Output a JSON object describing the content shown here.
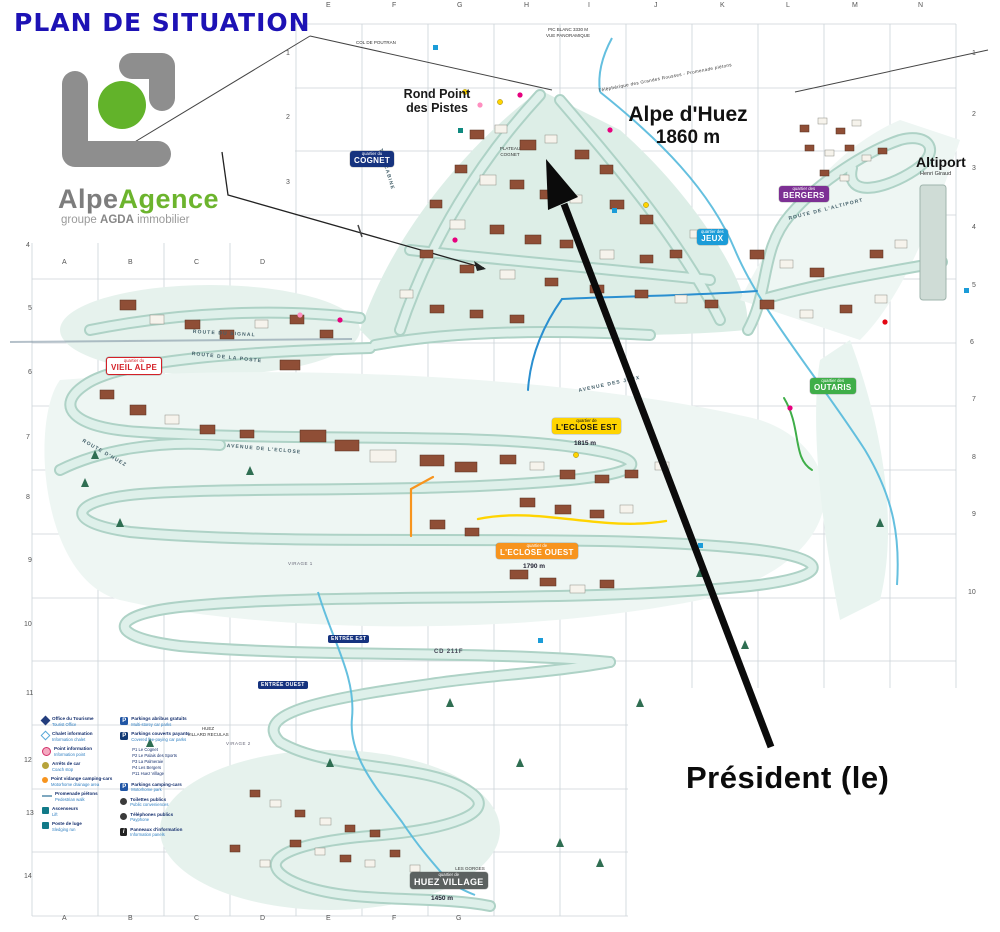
{
  "header": {
    "title": "PLAN DE SITUATION",
    "title_color": "#1d12b5"
  },
  "logo": {
    "brand_gray": "Alpe",
    "brand_green": "Agence",
    "tagline_prefix": "groupe",
    "tagline_bold": "AGDA",
    "tagline_suffix": "immobilier",
    "gray": "#8e8e8e",
    "green": "#62b32a"
  },
  "map": {
    "resort_name": "Alpe d'Huez",
    "resort_altitude": "1860 m",
    "rond_point": "Rond Point\ndes Pistes",
    "altiport": "Altiport",
    "altiport_sub": "Henri Giraud",
    "pic_blanc": "PIC BLANC 3330 M\nVUE PANORAMIQUE",
    "col_poutran": "COL DE POUTRAN",
    "plateau_cognet": "PLATEAU\nCOGNET",
    "telepherique": "Téléphérique des Grandes Rousses - Promenade piétons",
    "cd_road": "CD 211F",
    "gorges": "LES GORGES\nDE SARENNE",
    "villard": "HUEZ\nVILLARD RECULAS",
    "streets": [
      "TÉLÉCABINE",
      "ROUTE DU SIGNAL",
      "ROUTE DE LA POSTE",
      "AVENUE DE L'ECLOSE",
      "ROUTE D'HUEZ",
      "ROUTE DE L'ALTIPORT",
      "AVENUE DES JEUX",
      "VIRAGE 1",
      "VIRAGE 2"
    ]
  },
  "quartiers": {
    "cognet": {
      "prefix": "quartier du",
      "name": "COGNET",
      "color": "#16337f"
    },
    "bergers": {
      "prefix": "quartier des",
      "name": "BERGERS",
      "color": "#7d3094"
    },
    "jeux": {
      "prefix": "quartier des",
      "name": "JEUX",
      "color": "#1b9cd8"
    },
    "vieil_alpe": {
      "prefix": "quartier du",
      "name": "VIEIL ALPE",
      "color": "#d42027"
    },
    "outaris": {
      "prefix": "quartier des",
      "name": "OUTARIS",
      "color": "#3fae49"
    },
    "eclose_est": {
      "prefix": "quartier de",
      "name": "L'ECLOSE EST",
      "altitude": "1815 m",
      "color": "#ffd400"
    },
    "eclose_ouest": {
      "prefix": "quartier de",
      "name": "L'ECLOSE OUEST",
      "altitude": "1790 m",
      "color": "#f7941e"
    },
    "huez_village": {
      "prefix": "quartier de",
      "name": "HUEZ VILLAGE",
      "altitude": "1450 m",
      "color": "#5c6160"
    }
  },
  "entrances": {
    "est": "ENTRÉE EST",
    "ouest": "ENTRÉE OUEST"
  },
  "annotation": {
    "property": "Président (le)",
    "arrow_color": "#0b0b0b"
  },
  "grid": {
    "top_letters": [
      "E",
      "F",
      "G",
      "H",
      "I",
      "J",
      "K",
      "L",
      "M",
      "N"
    ],
    "mid_letters": [
      "A",
      "B",
      "C",
      "D"
    ],
    "bottom_letters": [
      "A",
      "B",
      "C",
      "D",
      "E",
      "F",
      "G"
    ],
    "left_numbers": [
      "1",
      "2",
      "3",
      "4",
      "5",
      "6",
      "7",
      "8",
      "9",
      "10",
      "11",
      "12",
      "13",
      "14"
    ],
    "right_numbers": [
      "1",
      "2",
      "3",
      "4",
      "5",
      "6",
      "7",
      "8",
      "9",
      "10"
    ]
  },
  "legend": {
    "p_symbol": "P",
    "i_symbol": "i",
    "left": [
      {
        "label": "Office du Tourisme",
        "sub": "Tourist Office"
      },
      {
        "label": "Chalet information",
        "sub": "Information chalet"
      },
      {
        "label": "Point information",
        "sub": "Information point"
      },
      {
        "label": "Arrêts de car",
        "sub": "Coach stop"
      },
      {
        "label": "Point vidange camping-cars",
        "sub": "Motorhome drainage area"
      },
      {
        "label": "Promenade piétons",
        "sub": "Pedestrian walk"
      },
      {
        "label": "Ascenseurs",
        "sub": "Lift"
      },
      {
        "label": "Poste de luge",
        "sub": "Sledging run"
      }
    ],
    "right": [
      {
        "label": "Parkings abribus gratuits",
        "sub": "Multi-storey car parks"
      },
      {
        "label": "Parkings couverts payants",
        "sub": "Covered fee-paying car parks"
      },
      {
        "label": "Parkings camping-cars",
        "sub": "Motorhome park"
      },
      {
        "label": "Toilettes publics",
        "sub": "Public conveniences"
      },
      {
        "label": "Téléphones publics",
        "sub": "Payphone"
      },
      {
        "label": "Panneaux d'information",
        "sub": "Information panels"
      }
    ],
    "parkings": [
      "P1 Le Cognet",
      "P2 Le Palais des Sports",
      "P3 La Palmeraie",
      "P4 Les Bergers",
      "P11 Huez Village"
    ]
  }
}
